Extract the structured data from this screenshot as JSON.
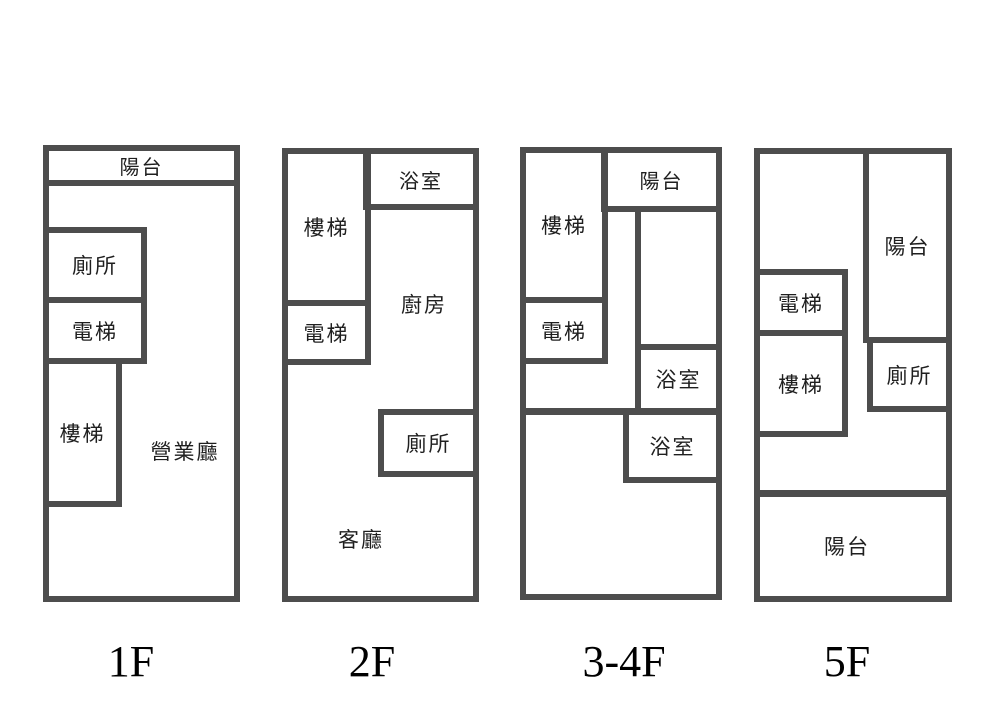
{
  "diagram": {
    "type": "building-floor-plans",
    "colors": {
      "wall": "#4d4d4d",
      "text": "#1f1f1f",
      "background": "#ffffff"
    }
  },
  "floors": [
    {
      "caption": "1F",
      "rooms": {
        "balcony": "陽台",
        "toilet": "廁所",
        "elevator": "電梯",
        "stairs": "樓梯",
        "business_hall": "營業廳"
      }
    },
    {
      "caption": "2F",
      "rooms": {
        "bathroom": "浴室",
        "stairs": "樓梯",
        "elevator": "電梯",
        "kitchen": "廚房",
        "toilet": "廁所",
        "living_room": "客廳"
      }
    },
    {
      "caption": "3-4F",
      "rooms": {
        "stairs": "樓梯",
        "balcony": "陽台",
        "elevator": "電梯",
        "bathroom_upper": "浴室",
        "bathroom_lower": "浴室"
      }
    },
    {
      "caption": "5F",
      "rooms": {
        "balcony_right": "陽台",
        "elevator": "電梯",
        "stairs": "樓梯",
        "toilet": "廁所",
        "balcony_bottom": "陽台"
      }
    }
  ]
}
